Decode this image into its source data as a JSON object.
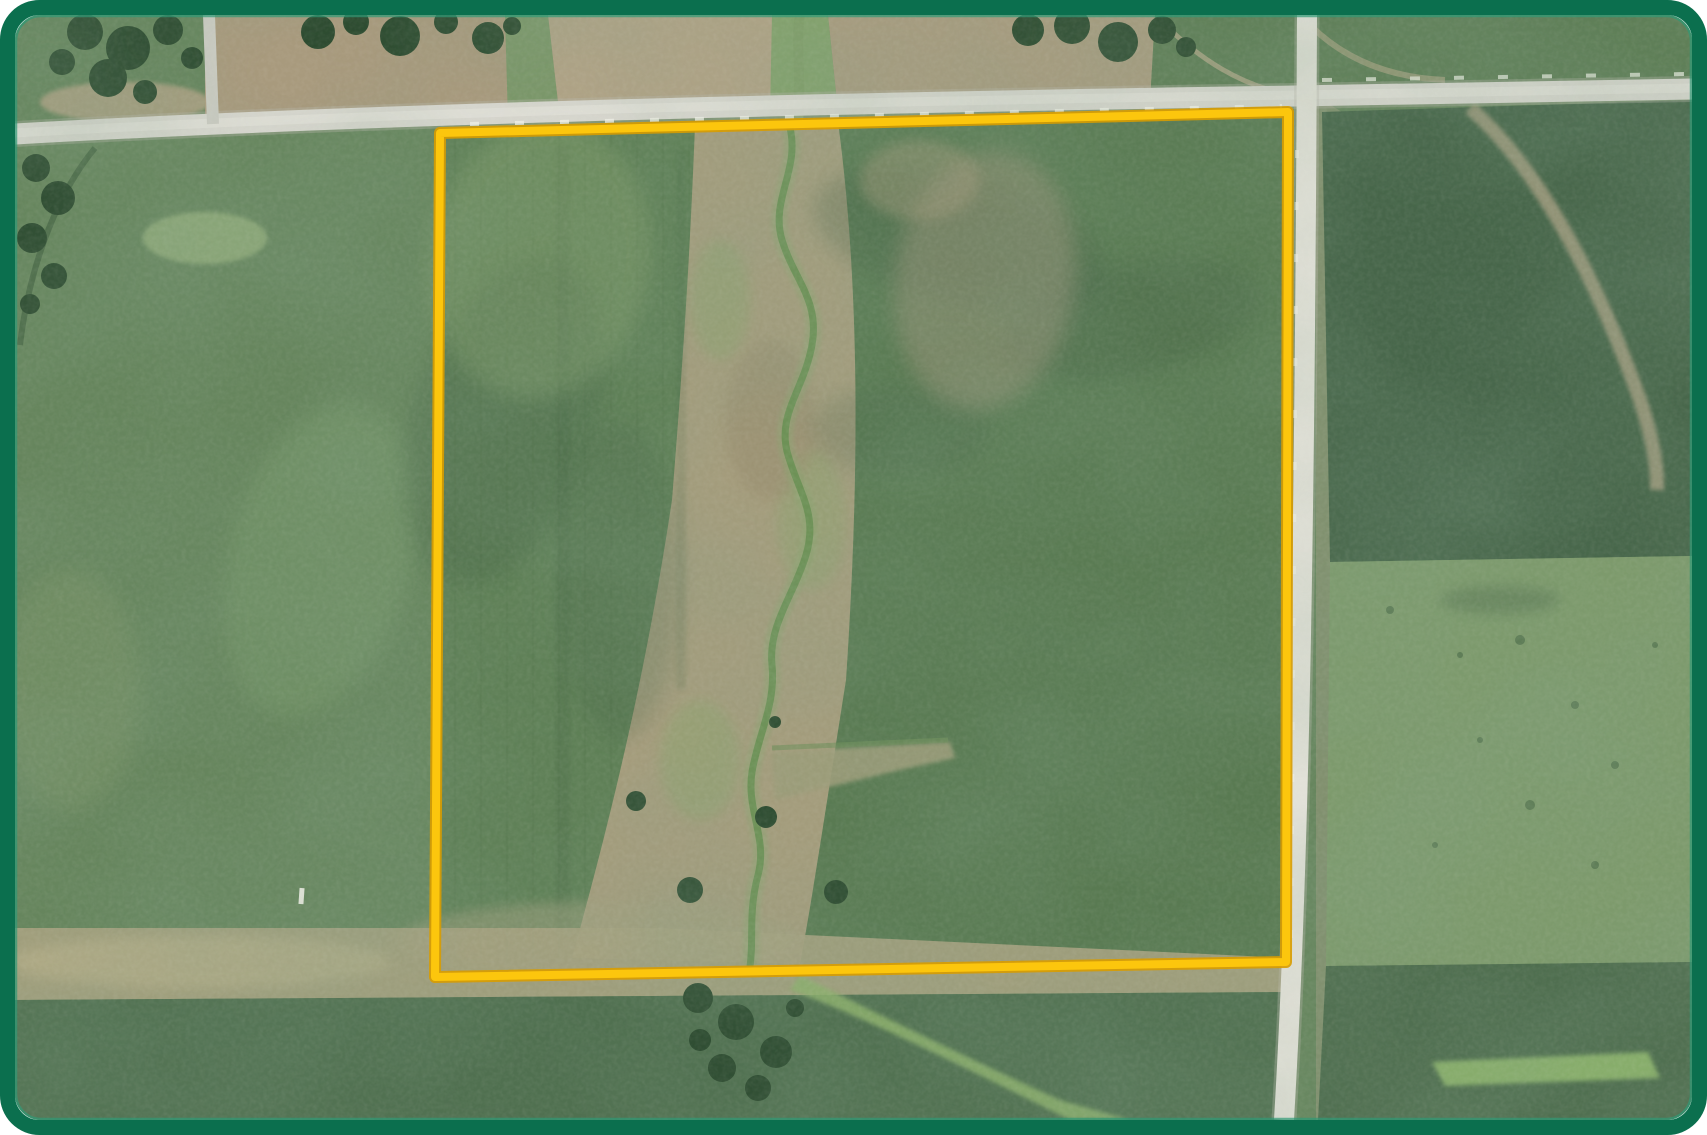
{
  "card": {
    "type": "aerial-parcel-photo",
    "background": "#ffffff"
  },
  "frame": {
    "border_color": "#0b6f4e",
    "inner_edge_color": "#2f9a76",
    "corner_radius": 32,
    "thickness": 15
  },
  "overlay": {
    "parcel_outline_color": "#fcc60d",
    "parcel_outline_casing_color": "#d89c00",
    "parcel_outline_width": 8,
    "parcel_corners": {
      "top_left": [
        440,
        133
      ],
      "top_right": [
        1288,
        112
      ],
      "bottom_right": [
        1286,
        962
      ],
      "bottom_left": [
        435,
        977
      ]
    }
  },
  "terrain": {
    "colors": {
      "base_field_green": "#66855d",
      "parcel_field_west_green": "#5f8057",
      "parcel_field_east_green": "#597a52",
      "dark_crop_field": "#47664a",
      "mottled_pasture": "#7d9a6c",
      "bottom_field_green": "#507050",
      "plowed_tan_west": "#a89a7d",
      "plowed_tan_mid": "#b1a386",
      "plowed_tan_east": "#a99c7f",
      "creek_corridor_tan": "#a49c7c",
      "creek_green": "#6d9156",
      "waterway_green": "#84a26d",
      "bright_grass_strip": "#8fb66d",
      "tree_dark_green": "#2d4b30",
      "road_surface": "#d8d7cf",
      "road_surface_bright": "#e2e1d8",
      "driveway_gray": "#ccccc3",
      "shoulder_dash_white": "#f3f3ea"
    },
    "features": [
      {
        "name": "east-west-gravel-road"
      },
      {
        "name": "north-south-gravel-road"
      },
      {
        "name": "farm-driveway"
      },
      {
        "name": "highlighted-parcel-boundary"
      },
      {
        "name": "creek-meander"
      },
      {
        "name": "creek-corridor"
      },
      {
        "name": "grassed-waterway"
      },
      {
        "name": "drainage-arm"
      },
      {
        "name": "tree-clusters"
      },
      {
        "name": "plowed-fields-north"
      },
      {
        "name": "crop-fields"
      },
      {
        "name": "pasture-field-east"
      }
    ]
  }
}
